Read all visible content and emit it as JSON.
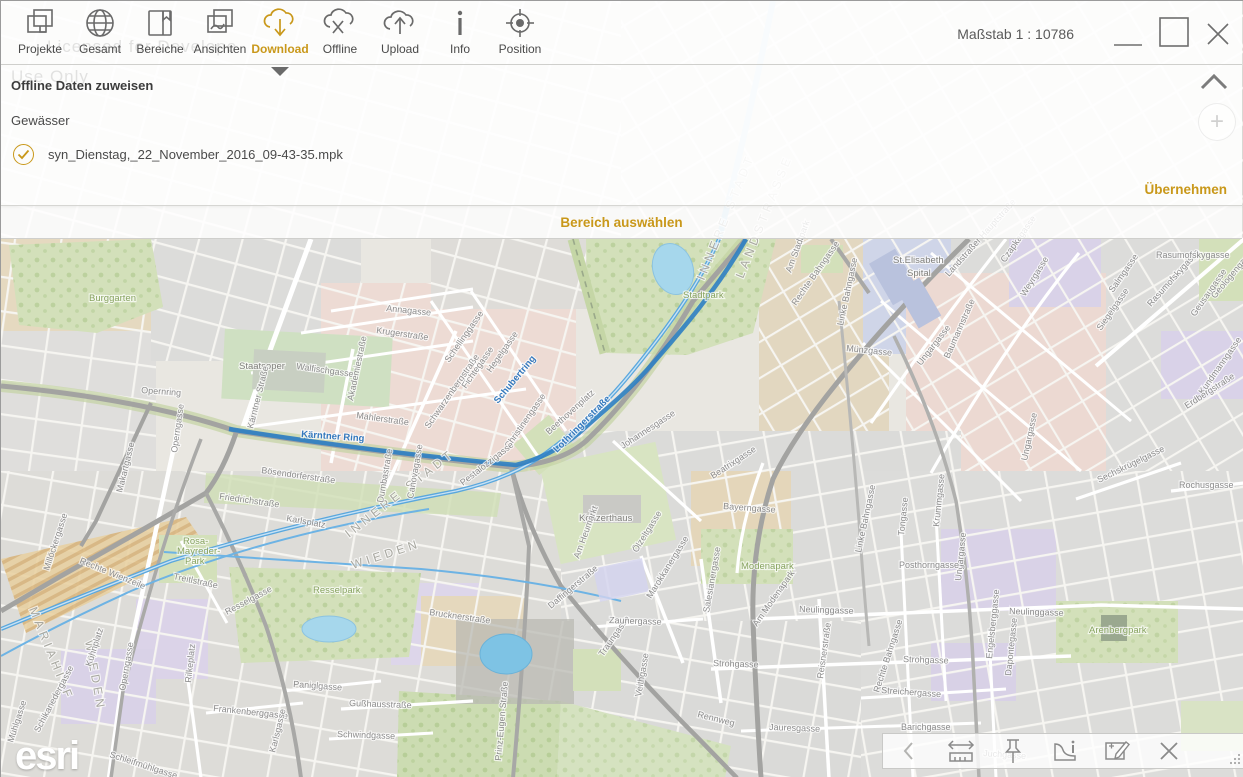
{
  "accent_color": "#c9981a",
  "window": {
    "scale_label": "Maßstab 1 : 10786",
    "controls": [
      "minimize",
      "maximize",
      "close"
    ]
  },
  "watermark": {
    "line1": "Licensed for Develope",
    "line2": "Use Only"
  },
  "toolbar": {
    "items": [
      {
        "label": "Projekte",
        "icon": "projects-icon",
        "active": false
      },
      {
        "label": "Gesamt",
        "icon": "globe-icon",
        "active": false
      },
      {
        "label": "Bereiche",
        "icon": "book-bookmark-icon",
        "active": false
      },
      {
        "label": "Ansichten",
        "icon": "map-views-icon",
        "active": false
      },
      {
        "label": "Download",
        "icon": "cloud-download-icon",
        "active": true
      },
      {
        "label": "Offline",
        "icon": "cloud-offline-icon",
        "active": false
      },
      {
        "label": "Upload",
        "icon": "cloud-upload-icon",
        "active": false
      },
      {
        "label": "Info",
        "icon": "info-icon",
        "active": false
      },
      {
        "label": "Position",
        "icon": "position-icon",
        "active": false
      }
    ]
  },
  "panel": {
    "title": "Offline Daten zuweisen",
    "layer": "Gewässer",
    "file": "syn_Dienstag,_22_November_2016_09-43-35.mpk",
    "apply_label": "Übernehmen"
  },
  "select_bar": {
    "label": "Bereich auswählen"
  },
  "bottom_toolbar": {
    "icons": [
      "chevron-left",
      "measure",
      "pin",
      "area-info",
      "edit-area",
      "close"
    ]
  },
  "map": {
    "logo": "esri",
    "route_color": "#2e7fc3",
    "river_color": "#5aa7dd",
    "labels": [
      {
        "t": "Kärntner Ring",
        "x": 300,
        "y": 436,
        "r": 4,
        "k": "bl"
      },
      {
        "t": "Schubertring",
        "x": 497,
        "y": 403,
        "r": -50,
        "k": "bl"
      },
      {
        "t": "Lothringerstraße",
        "x": 556,
        "y": 452,
        "r": -45,
        "k": "bl"
      },
      {
        "t": "INNERE STADT",
        "x": 348,
        "y": 537,
        "r": -38,
        "k": "di"
      },
      {
        "t": "WIEDEN",
        "x": 352,
        "y": 568,
        "r": -18,
        "k": "di"
      },
      {
        "t": "MARIAHILF",
        "x": 28,
        "y": 608,
        "r": 68,
        "k": "di"
      },
      {
        "t": "WIEDEN",
        "x": 84,
        "y": 640,
        "r": 80,
        "k": "di"
      },
      {
        "t": "INNERE STADT",
        "x": 703,
        "y": 280,
        "r": -68,
        "k": "di"
      },
      {
        "t": "LANDSTRASSE",
        "x": 742,
        "y": 278,
        "r": -68,
        "k": "di"
      },
      {
        "t": "Burggarten",
        "x": 88,
        "y": 300,
        "r": 0,
        "k": "pk"
      },
      {
        "t": "Stadtpark",
        "x": 682,
        "y": 297,
        "r": 0,
        "k": "pk"
      },
      {
        "t": "Resselpark",
        "x": 312,
        "y": 592,
        "r": 0,
        "k": "pk"
      },
      {
        "t": "Rosa-",
        "x": 182,
        "y": 543,
        "r": 0,
        "k": "pk",
        "s": 8.5
      },
      {
        "t": "Mayreder-",
        "x": 176,
        "y": 553,
        "r": 0,
        "k": "pk",
        "s": 8.5
      },
      {
        "t": "Park",
        "x": 184,
        "y": 563,
        "r": 0,
        "k": "pk",
        "s": 8.5
      },
      {
        "t": "Modenapark",
        "x": 740,
        "y": 568,
        "r": 0,
        "k": "pk"
      },
      {
        "t": "Arenbergpark",
        "x": 1088,
        "y": 632,
        "r": 0,
        "k": "pk"
      },
      {
        "t": "Staatsoper",
        "x": 238,
        "y": 368,
        "r": 0,
        "k": "pl"
      },
      {
        "t": "Konzerthaus",
        "x": 578,
        "y": 520,
        "r": 0,
        "k": "pl"
      },
      {
        "t": "St.Elisabeth",
        "x": 892,
        "y": 262,
        "r": 0,
        "k": "pl"
      },
      {
        "t": "Spital",
        "x": 906,
        "y": 275,
        "r": 0,
        "k": "pl"
      },
      {
        "t": "Annagasse",
        "x": 385,
        "y": 310,
        "r": 6,
        "k": "st"
      },
      {
        "t": "Krugerstraße",
        "x": 375,
        "y": 332,
        "r": 8,
        "k": "st"
      },
      {
        "t": "Walfischgasse",
        "x": 295,
        "y": 368,
        "r": 8,
        "k": "st"
      },
      {
        "t": "Mahlerstraße",
        "x": 355,
        "y": 417,
        "r": 8,
        "k": "st"
      },
      {
        "t": "Akademiestraße",
        "x": 352,
        "y": 400,
        "r": -78,
        "k": "st"
      },
      {
        "t": "Schwarzenbergstraße",
        "x": 428,
        "y": 428,
        "r": -55,
        "k": "st"
      },
      {
        "t": "Schellinggasse",
        "x": 448,
        "y": 362,
        "r": -55,
        "k": "st"
      },
      {
        "t": "Fichtegasse",
        "x": 465,
        "y": 388,
        "r": -55,
        "k": "st"
      },
      {
        "t": "Hegelgasse",
        "x": 490,
        "y": 372,
        "r": -55,
        "k": "st"
      },
      {
        "t": "Christinengasse",
        "x": 508,
        "y": 448,
        "r": -55,
        "k": "st"
      },
      {
        "t": "Pestalozzigasse",
        "x": 462,
        "y": 485,
        "r": -38,
        "k": "st"
      },
      {
        "t": "Opernring",
        "x": 140,
        "y": 392,
        "r": 4,
        "k": "st"
      },
      {
        "t": "Operngasse",
        "x": 176,
        "y": 452,
        "r": -82,
        "k": "st"
      },
      {
        "t": "Operngasse",
        "x": 124,
        "y": 690,
        "r": -80,
        "k": "st"
      },
      {
        "t": "Kärntner Straße",
        "x": 252,
        "y": 428,
        "r": -76,
        "k": "st"
      },
      {
        "t": "Bösendorferstraße",
        "x": 260,
        "y": 472,
        "r": 8,
        "k": "st"
      },
      {
        "t": "Friedrichstraße",
        "x": 218,
        "y": 498,
        "r": 8,
        "k": "st"
      },
      {
        "t": "Karlsplatz",
        "x": 285,
        "y": 520,
        "r": 10,
        "k": "st"
      },
      {
        "t": "Makartgasse",
        "x": 121,
        "y": 492,
        "r": -76,
        "k": "st"
      },
      {
        "t": "Rechte Wienzeile",
        "x": 78,
        "y": 562,
        "r": 22,
        "k": "st"
      },
      {
        "t": "Millöckergasse",
        "x": 48,
        "y": 570,
        "r": -72,
        "k": "st"
      },
      {
        "t": "Treitlstraße",
        "x": 172,
        "y": 578,
        "r": 12,
        "k": "st"
      },
      {
        "t": "Resselgasse",
        "x": 226,
        "y": 614,
        "r": -28,
        "k": "st"
      },
      {
        "t": "Schikanedergasse",
        "x": 38,
        "y": 732,
        "r": -62,
        "k": "st"
      },
      {
        "t": "Mühlgasse",
        "x": 12,
        "y": 742,
        "r": -72,
        "k": "st"
      },
      {
        "t": "Schleifmühlgasse",
        "x": 108,
        "y": 756,
        "r": 18,
        "k": "st"
      },
      {
        "t": "Kühnplatz",
        "x": 90,
        "y": 666,
        "r": -72,
        "k": "st"
      },
      {
        "t": "Rilkeplatz",
        "x": 190,
        "y": 682,
        "r": -84,
        "k": "st"
      },
      {
        "t": "Frankenberggasse",
        "x": 212,
        "y": 710,
        "r": 6,
        "k": "st"
      },
      {
        "t": "Paniglgasse",
        "x": 292,
        "y": 686,
        "r": 4,
        "k": "st"
      },
      {
        "t": "Karlsgasse",
        "x": 274,
        "y": 752,
        "r": -76,
        "k": "st"
      },
      {
        "t": "Gußhausstraße",
        "x": 348,
        "y": 705,
        "r": 2,
        "k": "st"
      },
      {
        "t": "Schwindgasse",
        "x": 336,
        "y": 736,
        "r": 2,
        "k": "st"
      },
      {
        "t": "Brucknerstraße",
        "x": 428,
        "y": 614,
        "r": 8,
        "k": "st"
      },
      {
        "t": "Prinz-Eugen-Straße",
        "x": 500,
        "y": 760,
        "r": -85,
        "k": "st"
      },
      {
        "t": "Traungasse",
        "x": 602,
        "y": 656,
        "r": -55,
        "k": "st"
      },
      {
        "t": "Daffingerstraße",
        "x": 550,
        "y": 608,
        "r": -40,
        "k": "st"
      },
      {
        "t": "Dumbastraße",
        "x": 382,
        "y": 502,
        "r": -80,
        "k": "st"
      },
      {
        "t": "Canovagasse",
        "x": 412,
        "y": 498,
        "r": -80,
        "k": "st"
      },
      {
        "t": "Johannesgasse",
        "x": 622,
        "y": 448,
        "r": -33,
        "k": "st"
      },
      {
        "t": "Am Heumarkt",
        "x": 578,
        "y": 558,
        "r": -70,
        "k": "st"
      },
      {
        "t": "Ölzeltgasse",
        "x": 636,
        "y": 552,
        "r": -58,
        "k": "st"
      },
      {
        "t": "Marokkanergasse",
        "x": 650,
        "y": 598,
        "r": -58,
        "k": "st"
      },
      {
        "t": "Beatrixgasse",
        "x": 712,
        "y": 478,
        "r": -33,
        "k": "st"
      },
      {
        "t": "Bayerngasse",
        "x": 722,
        "y": 508,
        "r": 4,
        "k": "st"
      },
      {
        "t": "Salesianergasse",
        "x": 708,
        "y": 612,
        "r": -80,
        "k": "st"
      },
      {
        "t": "Zaunergasse",
        "x": 608,
        "y": 622,
        "r": 2,
        "k": "st"
      },
      {
        "t": "Strohgasse",
        "x": 712,
        "y": 665,
        "r": 2,
        "k": "st"
      },
      {
        "t": "Strohgasse",
        "x": 902,
        "y": 661,
        "r": 2,
        "k": "st"
      },
      {
        "t": "Neulinggasse",
        "x": 798,
        "y": 611,
        "r": 2,
        "k": "st"
      },
      {
        "t": "Neulinggasse",
        "x": 1008,
        "y": 613,
        "r": 2,
        "k": "st"
      },
      {
        "t": "Am Modenapark",
        "x": 756,
        "y": 626,
        "r": -55,
        "k": "st"
      },
      {
        "t": "Reisnerstraße",
        "x": 822,
        "y": 678,
        "r": -82,
        "k": "st"
      },
      {
        "t": "Rechte Bahngasse",
        "x": 878,
        "y": 692,
        "r": -72,
        "k": "st"
      },
      {
        "t": "Rechte Bahngasse",
        "x": 795,
        "y": 305,
        "r": -55,
        "k": "st"
      },
      {
        "t": "Linke Bahngasse",
        "x": 860,
        "y": 552,
        "r": -78,
        "k": "st"
      },
      {
        "t": "Linke Bahngasse",
        "x": 842,
        "y": 325,
        "r": -78,
        "k": "st"
      },
      {
        "t": "Münzgasse",
        "x": 845,
        "y": 350,
        "r": 6,
        "k": "st"
      },
      {
        "t": "Ungargasse",
        "x": 920,
        "y": 365,
        "r": -52,
        "k": "st"
      },
      {
        "t": "Ungargasse",
        "x": 1026,
        "y": 460,
        "r": -78,
        "k": "st"
      },
      {
        "t": "Ungargasse",
        "x": 960,
        "y": 580,
        "r": -84,
        "k": "st"
      },
      {
        "t": "Landstraßer Hauptstraße",
        "x": 948,
        "y": 276,
        "r": -48,
        "k": "st"
      },
      {
        "t": "Baumannstraße",
        "x": 948,
        "y": 358,
        "r": -66,
        "k": "st"
      },
      {
        "t": "Weyrgasse",
        "x": 1024,
        "y": 296,
        "r": -58,
        "k": "st"
      },
      {
        "t": "Salmgasse",
        "x": 1112,
        "y": 292,
        "r": -55,
        "k": "st"
      },
      {
        "t": "Siegelgasse",
        "x": 1100,
        "y": 330,
        "r": -55,
        "k": "st"
      },
      {
        "t": "Rasumofskygasse",
        "x": 1150,
        "y": 306,
        "r": -48,
        "k": "st"
      },
      {
        "t": "Rasumofskygasse",
        "x": 1155,
        "y": 257,
        "r": 0,
        "k": "st"
      },
      {
        "t": "Geusaugasse",
        "x": 1194,
        "y": 316,
        "r": -55,
        "k": "st"
      },
      {
        "t": "Geologengasse",
        "x": 1214,
        "y": 298,
        "r": -50,
        "k": "st"
      },
      {
        "t": "Kundmanngasse",
        "x": 1202,
        "y": 394,
        "r": -55,
        "k": "st"
      },
      {
        "t": "Erdbergstraße",
        "x": 1186,
        "y": 408,
        "r": -33,
        "k": "st"
      },
      {
        "t": "Sechskrügelgasse",
        "x": 1098,
        "y": 482,
        "r": -26,
        "k": "st"
      },
      {
        "t": "Rochusgasse",
        "x": 1178,
        "y": 487,
        "r": 0,
        "k": "st"
      },
      {
        "t": "Posthorngasse",
        "x": 898,
        "y": 567,
        "r": 0,
        "k": "st"
      },
      {
        "t": "Tongasse",
        "x": 903,
        "y": 535,
        "r": -84,
        "k": "st"
      },
      {
        "t": "Krummgasse",
        "x": 938,
        "y": 526,
        "r": -84,
        "k": "st"
      },
      {
        "t": "Streichergasse",
        "x": 880,
        "y": 692,
        "r": 4,
        "k": "st"
      },
      {
        "t": "Engelsberggasse",
        "x": 991,
        "y": 658,
        "r": -84,
        "k": "st"
      },
      {
        "t": "Dapontegasse",
        "x": 1010,
        "y": 675,
        "r": -84,
        "k": "st"
      },
      {
        "t": "Jauresgasse",
        "x": 768,
        "y": 729,
        "r": 2,
        "k": "st"
      },
      {
        "t": "Veithgasse",
        "x": 640,
        "y": 696,
        "r": -80,
        "k": "st"
      },
      {
        "t": "Rennweg",
        "x": 696,
        "y": 716,
        "r": 14,
        "k": "st"
      },
      {
        "t": "Barichgasse",
        "x": 900,
        "y": 729,
        "r": 0,
        "k": "st"
      },
      {
        "t": "Juchgasse",
        "x": 982,
        "y": 755,
        "r": 4,
        "k": "st"
      },
      {
        "t": "Czapkagasse",
        "x": 1004,
        "y": 262,
        "r": -55,
        "k": "st"
      },
      {
        "t": "Am Stadtpark",
        "x": 790,
        "y": 272,
        "r": -70,
        "k": "st"
      },
      {
        "t": "Beethovenplatz",
        "x": 548,
        "y": 434,
        "r": -42,
        "k": "st"
      }
    ]
  }
}
